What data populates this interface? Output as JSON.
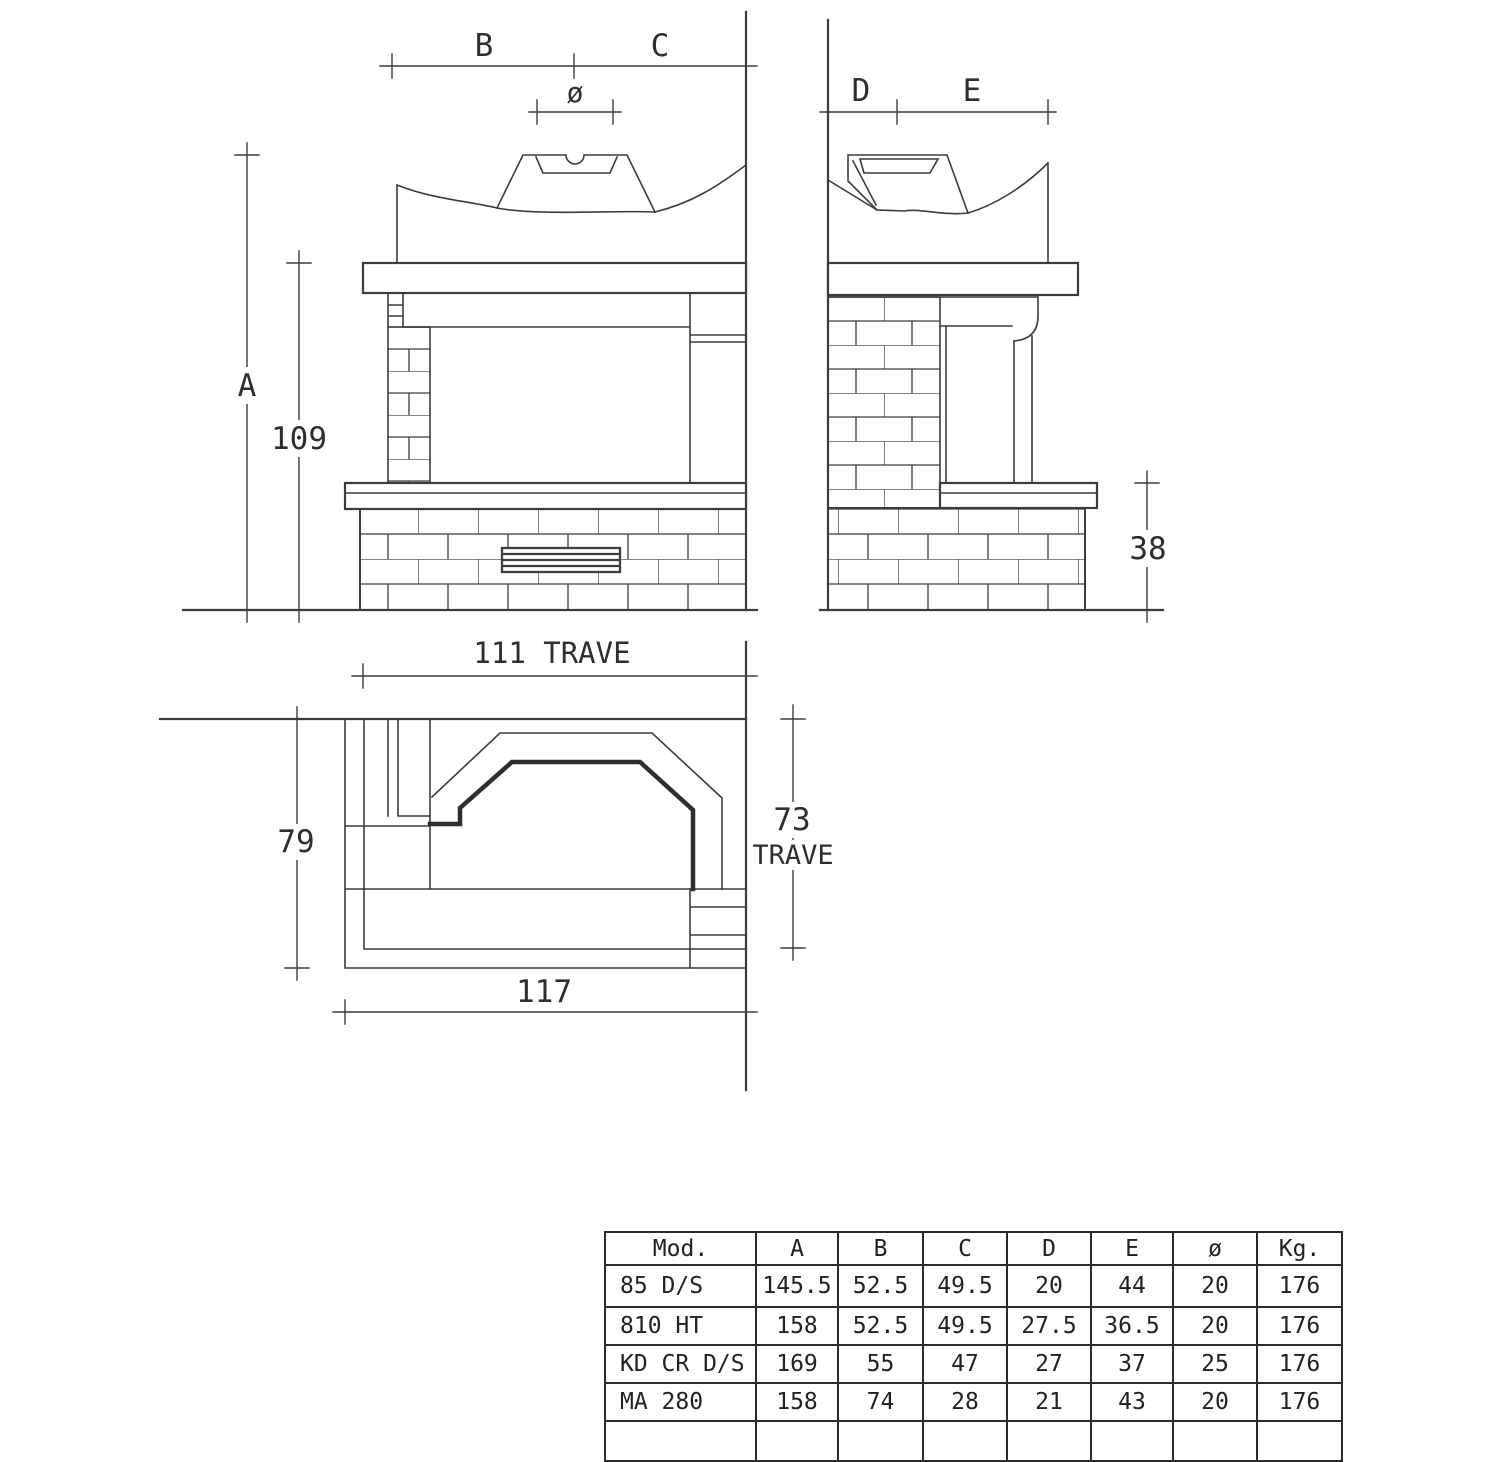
{
  "page": {
    "background": "#ffffff",
    "line_color": "#3c3c3c"
  },
  "front_view": {
    "label_b": "B",
    "label_c": "C",
    "label_diameter": "ø",
    "label_a": "A",
    "label_mantel_height": "109"
  },
  "side_view": {
    "label_d": "D",
    "label_e": "E",
    "label_plinth_height": "38"
  },
  "plan_view": {
    "label_beam_width": "111 TRAVE",
    "label_depth": "79",
    "label_beam_depth": "73",
    "label_beam_depth_unit": "TRAVE",
    "label_overall_width": "117"
  },
  "table": {
    "headers": [
      "Mod.",
      "A",
      "B",
      "C",
      "D",
      "E",
      "ø",
      "Kg."
    ],
    "rows": [
      [
        "85 D/S",
        "145.5",
        "52.5",
        "49.5",
        "20",
        "44",
        "20",
        "176"
      ],
      [
        "810 HT",
        "158",
        "52.5",
        "49.5",
        "27.5",
        "36.5",
        "20",
        "176"
      ],
      [
        "KD CR D/S",
        "169",
        "55",
        "47",
        "27",
        "37",
        "25",
        "176"
      ],
      [
        "MA 280",
        "158",
        "74",
        "28",
        "21",
        "43",
        "20",
        "176"
      ]
    ]
  }
}
